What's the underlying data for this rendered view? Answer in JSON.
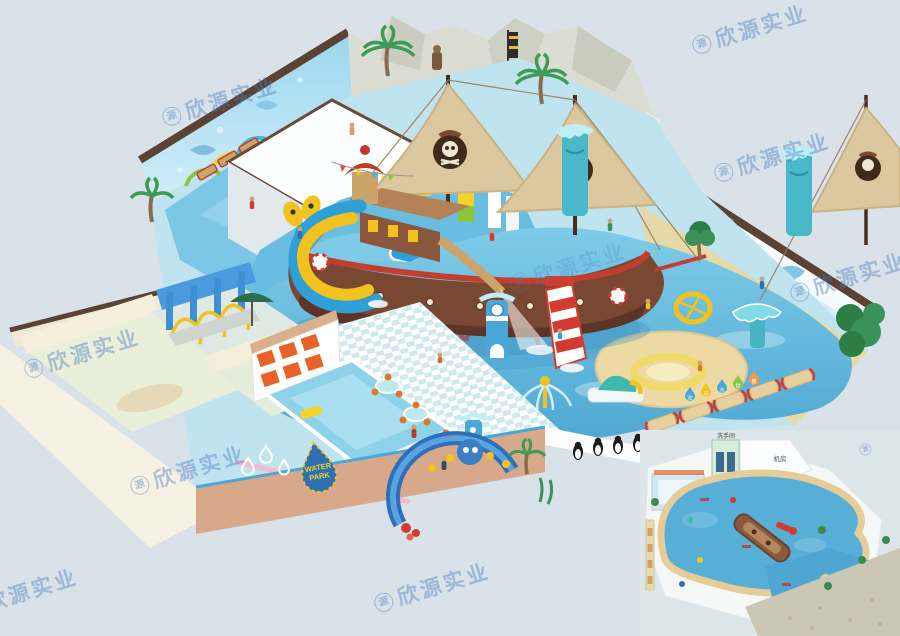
{
  "canvas": {
    "width": 900,
    "height": 636,
    "background": "#d9e2e9"
  },
  "watermark": {
    "logo_char": "源",
    "text": "欣源实业",
    "color": "#4a7bc0"
  },
  "signs": {
    "water_park_line1": "WATER",
    "water_park_line2": "PARK",
    "drop_pennant_chars": [
      "欢",
      "乐",
      "水",
      "世",
      "界"
    ]
  },
  "floor_plan": {
    "restroom_label": "洗手间",
    "machine_room_label": "机房"
  },
  "palette": {
    "background": "#d9e2e9",
    "wall_trim": "#5b4233",
    "mural_blue": "#8fd0ec",
    "rock": "#dcddd2",
    "water": "#5fb4da",
    "deck": "#bfe3ef",
    "sand": "#ead79f",
    "ship_hull": "#7a4a33",
    "ship_red": "#c23f2f",
    "sail": "#dcc89e",
    "slide_yellow": "#f2c21f",
    "slide_blue": "#2f9fd8",
    "slide_red": "#d23b30",
    "front_wall": "#d8a88b",
    "locker_orange": "#e8622a",
    "shower_blue": "#3f8fd4",
    "teal_tower": "#49b8c9",
    "plan_water": "#57aed6",
    "plan_path": "#e6cc96"
  }
}
